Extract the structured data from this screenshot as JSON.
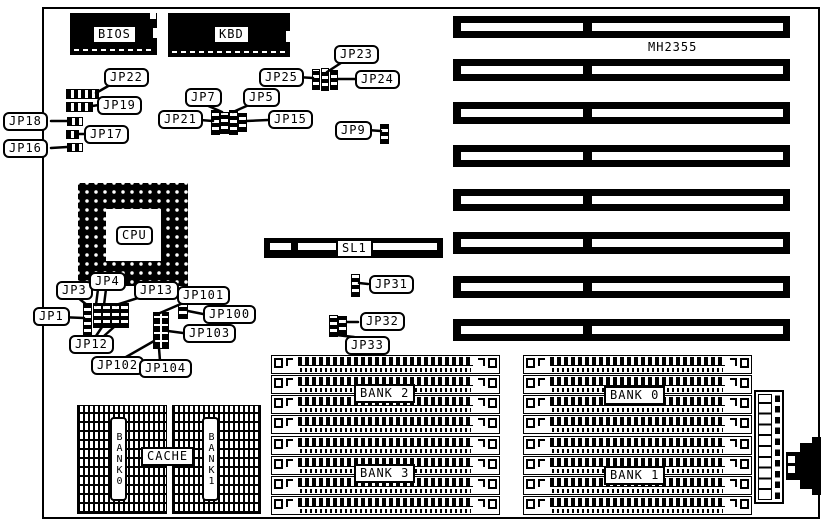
{
  "diagram": {
    "board_model": "MH2355",
    "chips": {
      "bios": "BIOS",
      "kbd": "KBD",
      "cpu": "CPU",
      "cache": "CACHE"
    },
    "slot_label": "SL1",
    "cache_banks": {
      "bank0": "BANK0",
      "bank1": "BANK1"
    },
    "memory_banks": {
      "bank0": "BANK 0",
      "bank1": "BANK 1",
      "bank2": "BANK 2",
      "bank3": "BANK 3"
    },
    "jumpers": {
      "jp1": "JP1",
      "jp3": "JP3",
      "jp4": "JP4",
      "jp5": "JP5",
      "jp7": "JP7",
      "jp9": "JP9",
      "jp12": "JP12",
      "jp13": "JP13",
      "jp15": "JP15",
      "jp16": "JP16",
      "jp17": "JP17",
      "jp18": "JP18",
      "jp19": "JP19",
      "jp21": "JP21",
      "jp22": "JP22",
      "jp23": "JP23",
      "jp24": "JP24",
      "jp25": "JP25",
      "jp31": "JP31",
      "jp32": "JP32",
      "jp33": "JP33",
      "jp100": "JP100",
      "jp101": "JP101",
      "jp102": "JP102",
      "jp103": "JP103",
      "jp104": "JP104"
    },
    "colors": {
      "ink": "#000000",
      "paper": "#ffffff"
    }
  }
}
